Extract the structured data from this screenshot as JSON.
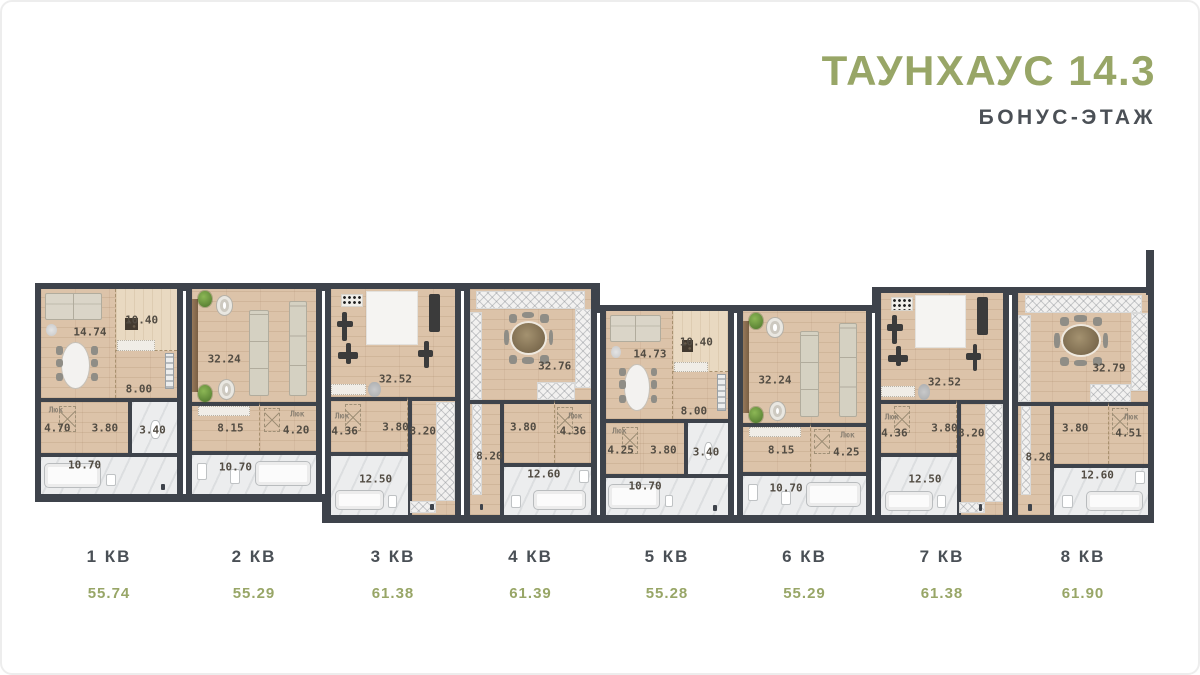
{
  "header": {
    "title": "ТАУНХАУС 14.3",
    "subtitle": "БОНУС-ЭТАЖ"
  },
  "hatch_text": "Люк",
  "units": [
    {
      "label": "1 КВ",
      "total_area": "55.74",
      "type": "A",
      "rooms": {
        "living": "14.74",
        "kitchen": "10.40",
        "hall": "8.00",
        "hatch": "4.70",
        "r1": "3.80",
        "wc": "3.40",
        "bath": "10.70"
      }
    },
    {
      "label": "2 КВ",
      "total_area": "55.29",
      "type": "B",
      "rooms": {
        "living": "32.24",
        "kitchen": "8.15",
        "hatch": "4.20",
        "bath": "10.70"
      }
    },
    {
      "label": "3 КВ",
      "total_area": "61.38",
      "type": "C",
      "rooms": {
        "gym": "32.52",
        "hatch": "4.36",
        "r1": "3.80",
        "corridor": "8.20",
        "bath": "12.50"
      }
    },
    {
      "label": "4 КВ",
      "total_area": "61.39",
      "type": "D",
      "rooms": {
        "main": "32.76",
        "r1": "3.80",
        "hatch": "4.36",
        "corridor": "8.20",
        "bath": "12.60"
      }
    },
    {
      "label": "5 КВ",
      "total_area": "55.28",
      "type": "A",
      "rooms": {
        "living": "14.73",
        "kitchen": "10.40",
        "hall": "8.00",
        "hatch": "4.25",
        "r1": "3.80",
        "wc": "3.40",
        "bath": "10.70"
      }
    },
    {
      "label": "6 КВ",
      "total_area": "55.29",
      "type": "B",
      "rooms": {
        "living": "32.24",
        "kitchen": "8.15",
        "hatch": "4.25",
        "bath": "10.70"
      }
    },
    {
      "label": "7 КВ",
      "total_area": "61.38",
      "type": "C",
      "rooms": {
        "gym": "32.52",
        "hatch": "4.36",
        "r1": "3.80",
        "corridor": "8.20",
        "bath": "12.50"
      }
    },
    {
      "label": "8 КВ",
      "total_area": "61.90",
      "type": "D",
      "rooms": {
        "main": "32.79",
        "r1": "3.80",
        "hatch": "4.51",
        "corridor": "8.20",
        "bath": "12.60"
      }
    }
  ],
  "colors": {
    "accent_green": "#98a667",
    "label_dark": "#4a5056",
    "wall": "#3e434b",
    "wood_floor": "#dcc3a9",
    "wood_light": "#e9d9c1",
    "tile": "#ecedee"
  }
}
